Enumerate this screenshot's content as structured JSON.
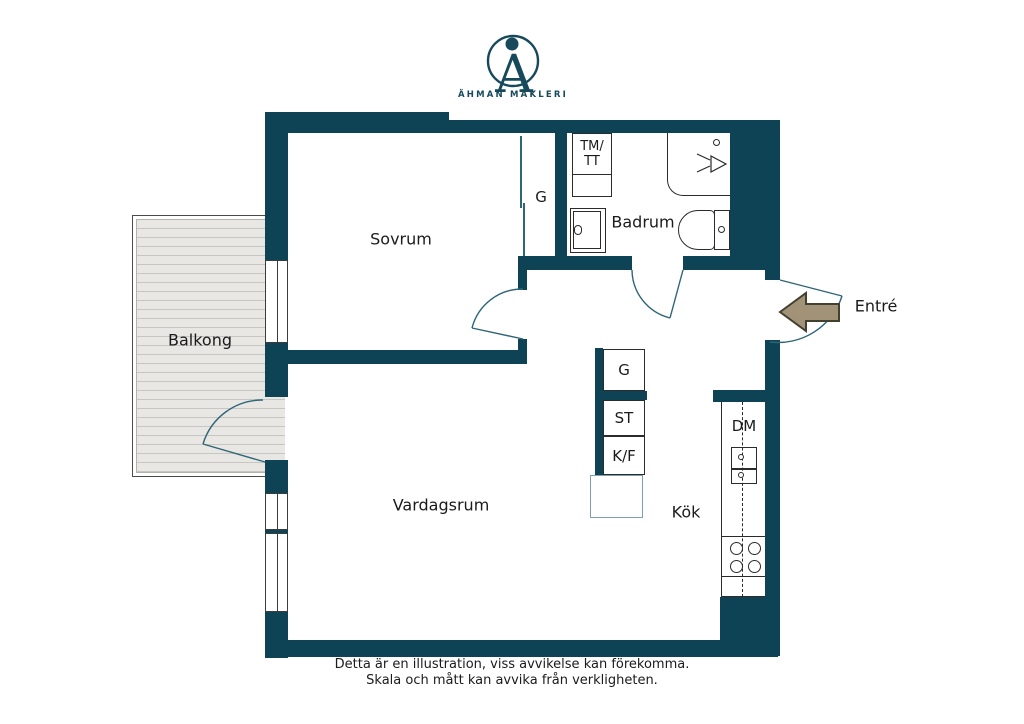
{
  "logo": {
    "brand": "ÄHMAN MÄKLERI"
  },
  "rooms": {
    "sovrum": "Sovrum",
    "badrum": "Badrum",
    "balkong": "Balkong",
    "vardagsrum": "Vardagsrum",
    "kok": "Kök",
    "entre": "Entré"
  },
  "labels": {
    "closet_g": "G",
    "kitchen_g": "G",
    "st": "ST",
    "kf": "K/F",
    "dm": "DM",
    "tm_line1": "TM/",
    "tm_line2": "TT"
  },
  "footer": {
    "line1": "Detta är en illustration, viss avvikelse kan förekomma.",
    "line2": "Skala och mått kan avvika från verkligheten."
  },
  "colors": {
    "wall": "#0d4355",
    "line": "#2e6577",
    "outline": "#2b2b2b",
    "deck": "#e8e7e4",
    "deck_stripe": "#c7c6c2",
    "balcony_border": "#4a4a4a",
    "text": "#1b1b1b",
    "brand": "#16495c",
    "arrow_fill": "#a29378",
    "arrow_stroke": "#42402e",
    "box_teal": "#7ba0ad"
  }
}
